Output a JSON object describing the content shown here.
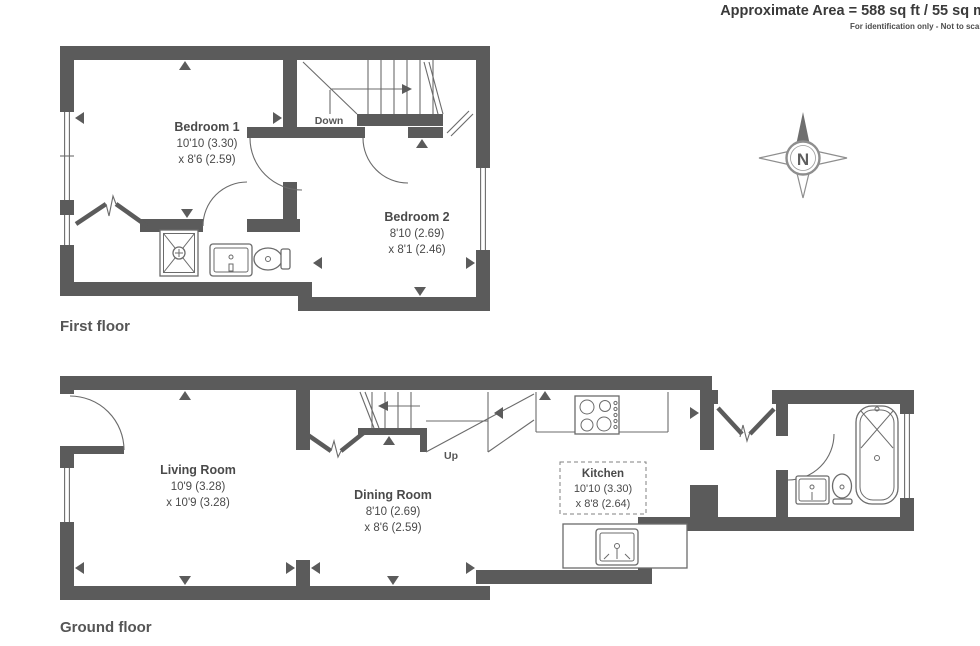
{
  "header": {
    "area_label": "Approximate Area = 588 sq ft / 55 sq m",
    "disclaimer": "For identification only - Not to scale"
  },
  "compass": {
    "north_label": "N"
  },
  "first_floor": {
    "caption": "First floor",
    "stairs_label": "Down",
    "rooms": [
      {
        "name": "Bedroom 1",
        "dim1": "10'10 (3.30)",
        "dim2": "x 8'6 (2.59)"
      },
      {
        "name": "Bedroom 2",
        "dim1": "8'10 (2.69)",
        "dim2": "x 8'1 (2.46)"
      }
    ]
  },
  "ground_floor": {
    "caption": "Ground floor",
    "stairs_label": "Up",
    "rooms": [
      {
        "name": "Living Room",
        "dim1": "10'9 (3.28)",
        "dim2": "x 10'9 (3.28)"
      },
      {
        "name": "Dining Room",
        "dim1": "8'10 (2.69)",
        "dim2": "x 8'6 (2.59)"
      },
      {
        "name": "Kitchen",
        "dim1": "10'10 (3.30)",
        "dim2": "x 8'8 (2.64)"
      }
    ]
  },
  "colors": {
    "wall": "#5b5b5b",
    "line": "#6b6b6b",
    "text": "#4a4a4a",
    "caption_text": "#555555",
    "header_text": "#3a3a3a"
  }
}
